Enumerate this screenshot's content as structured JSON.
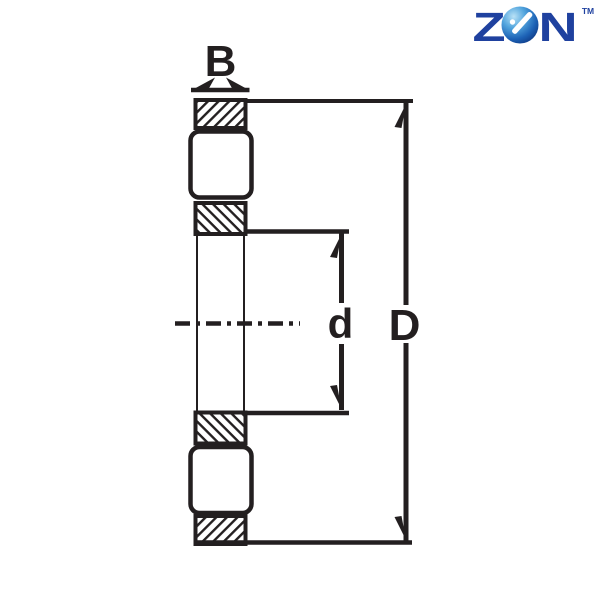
{
  "logo": {
    "letter_z": "Z",
    "letter_n": "N",
    "trademark": "TM",
    "letters_color": "#1f419f",
    "sphere_color_highlight": "#b9e2f6",
    "sphere_color_mid": "#3d8fd4",
    "sphere_color_dark": "#0a2c74"
  },
  "diagram": {
    "label_width": "B",
    "label_bore_diameter": "d",
    "label_outer_diameter": "D",
    "line_color": "#231f20",
    "background_color": "#ffffff"
  }
}
